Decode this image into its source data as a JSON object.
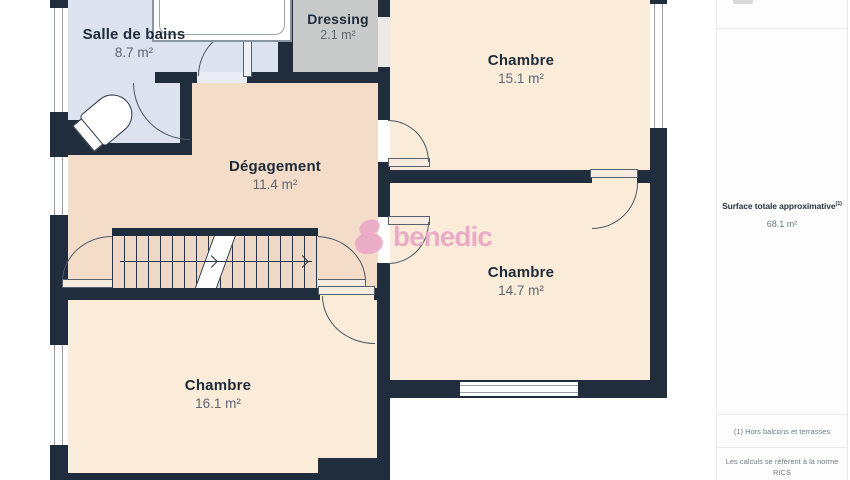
{
  "rooms": [
    {
      "name": "Salle de bains",
      "area": "8.7 m²"
    },
    {
      "name": "Dressing",
      "area": "2.1 m²"
    },
    {
      "name": "Chambre",
      "area": "15.1 m²"
    },
    {
      "name": "Dégagement",
      "area": "11.4 m²"
    },
    {
      "name": "Chambre",
      "area": "14.7 m²"
    },
    {
      "name": "Chambre",
      "area": "16.1 m²"
    }
  ],
  "watermark": {
    "brand": "benedic"
  },
  "sidebar": {
    "surface_label": "Surface totale approximative",
    "surface_note_ref": "(1)",
    "surface_value": "68.1 m²",
    "footnote_1": "(1) Hors balcons et terrasses",
    "footnote_2_line1": "Les calculs se réfèrent à la norme RICS",
    "footnote_2_line2": "IPMS 3C. Toutes les mesures sont"
  },
  "colors": {
    "wall": "#1f2d3d",
    "bathroom_floor": "#dce2ee",
    "dressing_floor": "#c9cbca",
    "bedroom_floor": "#fbecd9",
    "hallway_floor": "#f3dcc8",
    "stair_floor": "#eed9c6",
    "watermark_pink": "#eaa8c5"
  }
}
